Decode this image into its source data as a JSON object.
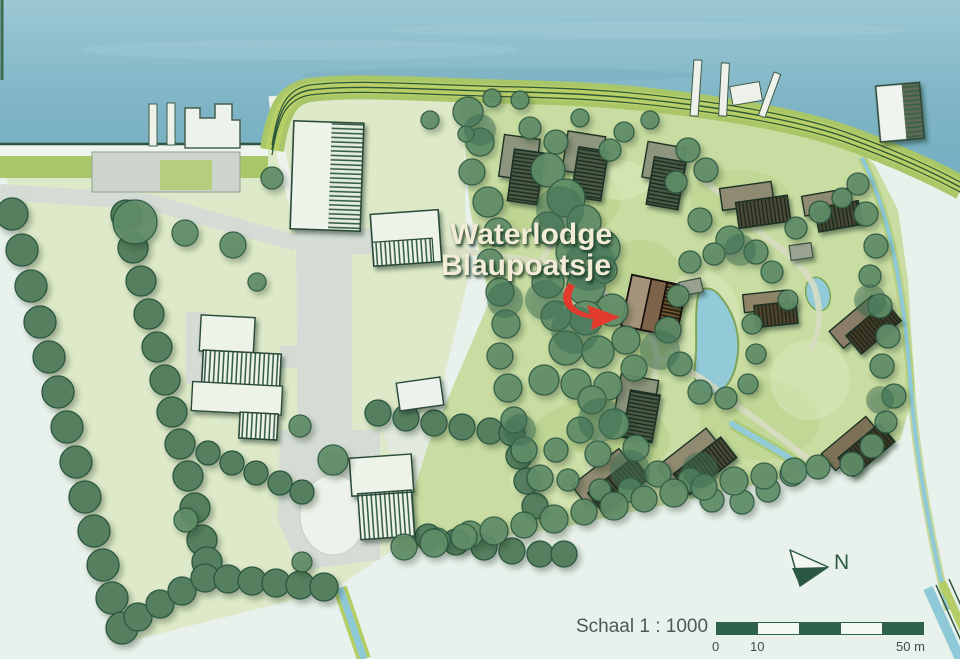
{
  "map": {
    "title_line1": "Waterlodge",
    "title_line2": "Blaupoatsje",
    "compass": {
      "label": "N"
    },
    "scale": {
      "label": "Schaal 1 : 1000",
      "tick_start": "0",
      "tick_mid": "10",
      "tick_end": "50 m"
    },
    "colors": {
      "lake_water": "#84b9c8",
      "pond_water": "#92cad8",
      "farm_field": "#dde9c8",
      "resort_ground": "#c9dda3",
      "tree_green": "#5f8c68",
      "hedge_outline": "#2b573f",
      "dike_road": "#b8cf68",
      "road_gray": "#d5dcd5",
      "highlight_lodge_brown": "#7c6448",
      "arrow_red": "#e23b2d",
      "scalebar_green": "#2e6149",
      "title_cream": "#f2ecd7",
      "compass_green": "#2c5743"
    }
  }
}
